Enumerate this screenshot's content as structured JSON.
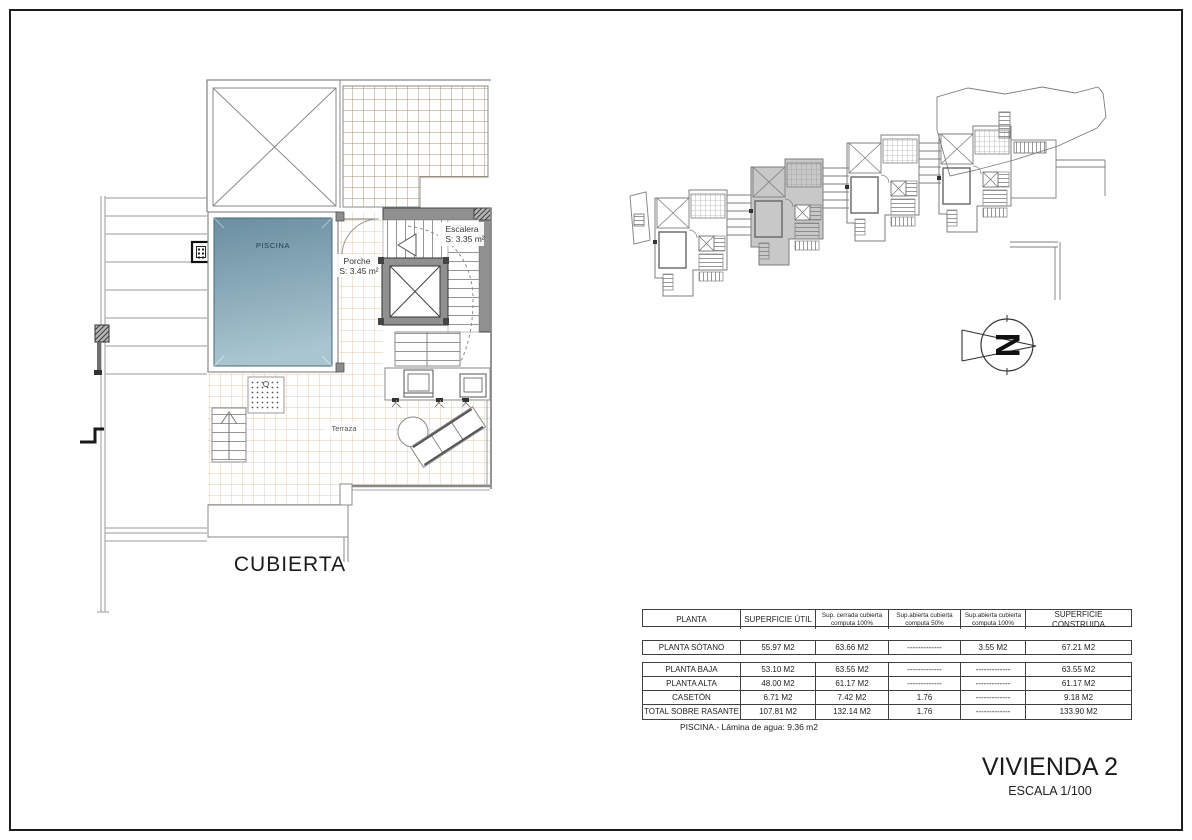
{
  "sheet": {
    "drawing_title": "CUBIERTA",
    "project_title": "VIVIENDA 2",
    "scale_label": "ESCALA 1/100"
  },
  "floor_plan": {
    "pool_label": "PISCINA",
    "porch_label": "Porche",
    "porch_area": "S: 3.45 m²",
    "stairs_label": "Escalera",
    "stairs_area": "S: 3.35 m²",
    "terrace_label": "Terraza"
  },
  "north_arrow": {
    "letter": "N"
  },
  "colors": {
    "pool_top": "#6a8ea1",
    "pool_bottom": "#a9c6d0",
    "tile_line": "#e2c8a4",
    "wall_fill": "#909090",
    "site_highlight": "#c8c8c8"
  },
  "areas_table": {
    "headers": [
      [
        "PLANTA"
      ],
      [
        "SUPERFICIE ÚTIL"
      ],
      [
        "Sup. cerrada cubierta",
        "computa 100%"
      ],
      [
        "Sup.abierta cubierta",
        "computa 50%"
      ],
      [
        "Sup.abierta cubierta",
        "computa 100%"
      ],
      [
        "SUPERFICIE CONSTRUIDA"
      ]
    ],
    "rows": [
      {
        "cells": [
          "PLANTA SÓTANO",
          "55.97 M2",
          "63.66 M2",
          "-------------",
          "3.55 M2",
          "67.21 M2"
        ]
      },
      {
        "cells": [
          "PLANTA BAJA",
          "53.10 M2",
          "63.55 M2",
          "-------------",
          "-------------",
          "63.55 M2"
        ]
      },
      {
        "cells": [
          "PLANTA ALTA",
          "48.00 M2",
          "61.17 M2",
          "-------------",
          "-------------",
          "61.17 M2"
        ]
      },
      {
        "cells": [
          "CASETÓN",
          "6.71 M2",
          "7.42 M2",
          "1.76",
          "-------------",
          "9.18 M2"
        ]
      },
      {
        "cells": [
          "TOTAL SOBRE RASANTE",
          "107.81 M2",
          "132.14 M2",
          "1.76",
          "-------------",
          "133.90 M2"
        ]
      }
    ],
    "footnote": "PISCINA.- Lámina de agua: 9.36 m2"
  }
}
